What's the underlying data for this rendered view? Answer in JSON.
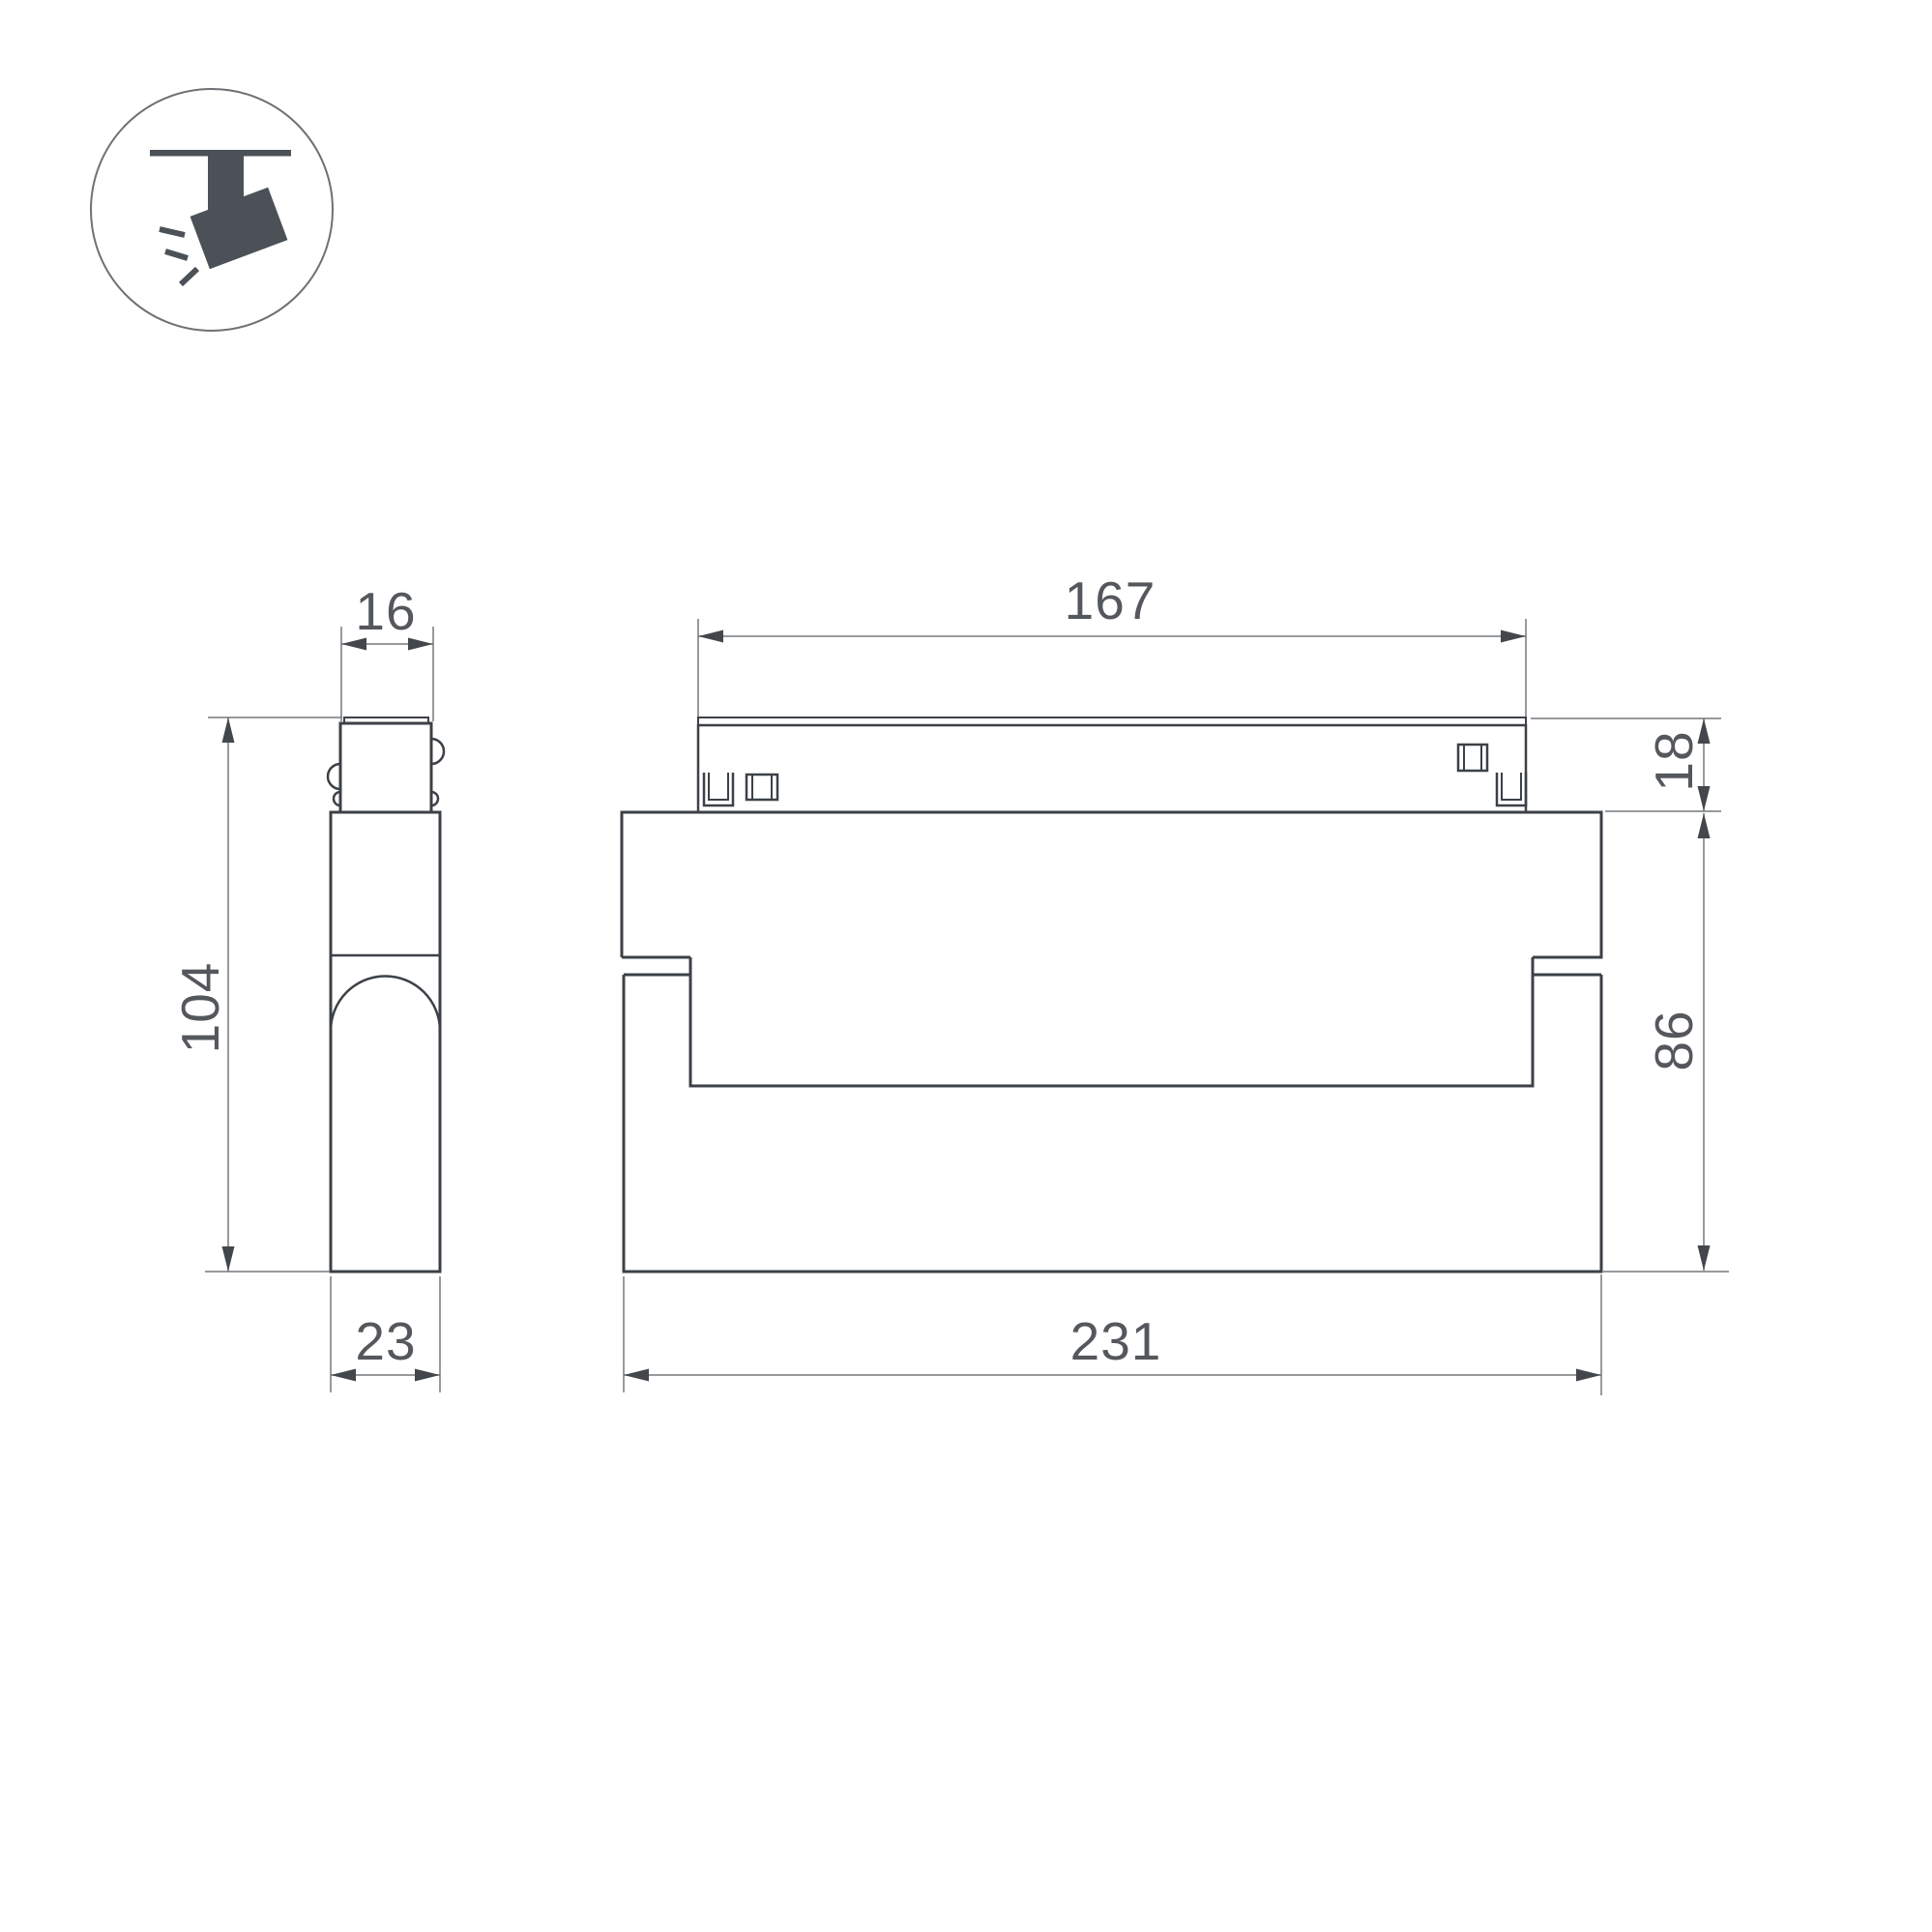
{
  "page": {
    "kind": "technical-dimension-drawing",
    "background": "#ffffff"
  },
  "icon": {
    "name": "ceiling-track-spotlight-pictogram",
    "color": "#4b5157",
    "circle_stroke": "#6d7175"
  },
  "views": {
    "side": {
      "name": "side-view",
      "dims": {
        "neck_width": "16",
        "height": "104",
        "depth": "23"
      }
    },
    "front": {
      "name": "front-view",
      "dims": {
        "track_length": "167",
        "track_height": "18",
        "body_height": "86",
        "total_length": "231"
      }
    }
  },
  "colors": {
    "outline": "#3c4147",
    "dimension_line": "#75797d",
    "dimension_text": "#54585c",
    "arrow": "#43474c"
  }
}
